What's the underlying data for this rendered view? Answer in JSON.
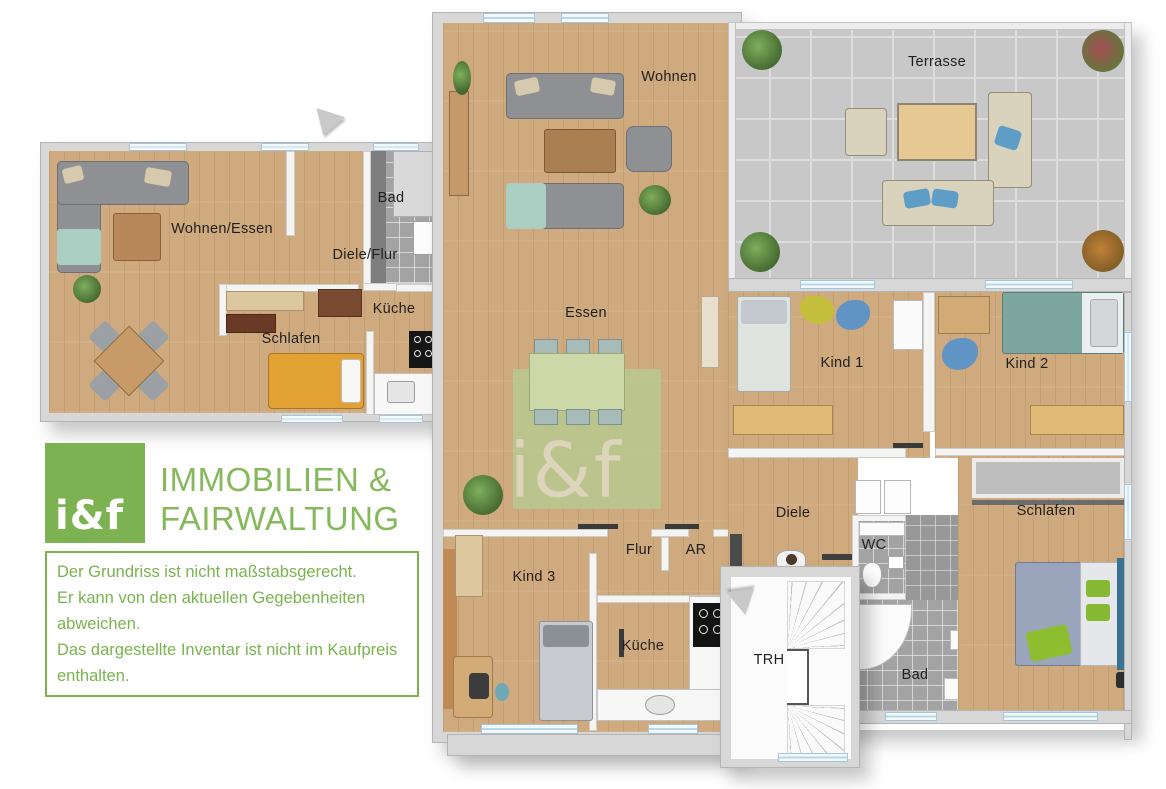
{
  "branding": {
    "logo_text": "i&f",
    "company_name_line1": "IMMOBILIEN &",
    "company_name_line2": "FAIRWALTUNG",
    "brand_green": "#7cb251",
    "disclaimer": {
      "line1": "Der Grundriss ist nicht maßstabsgerecht.",
      "line2": "Er kann von den aktuellen Gegebenheiten abweichen.",
      "line3": "Das dargestellte Inventar ist nicht im Kaufpreis enthalten."
    }
  },
  "watermark_text": "i&f",
  "floorplan": {
    "rooms": {
      "left_wohnen_essen": {
        "label": "Wohnen/Essen"
      },
      "left_diele_flur": {
        "label": "Diele/Flur"
      },
      "left_bad": {
        "label": "Bad"
      },
      "left_kueche": {
        "label": "Küche"
      },
      "left_schlafen": {
        "label": "Schlafen"
      },
      "main_wohnen": {
        "label": "Wohnen"
      },
      "main_essen": {
        "label": "Essen"
      },
      "terrasse": {
        "label": "Terrasse"
      },
      "kind_1": {
        "label": "Kind 1"
      },
      "kind_2": {
        "label": "Kind 2"
      },
      "diele": {
        "label": "Diele"
      },
      "wc": {
        "label": "WC"
      },
      "main_schlafen": {
        "label": "Schlafen"
      },
      "kind_3": {
        "label": "Kind 3"
      },
      "flur": {
        "label": "Flur"
      },
      "ar": {
        "label": "AR"
      },
      "main_kueche": {
        "label": "Küche"
      },
      "trh": {
        "label": "TRH"
      },
      "main_bad": {
        "label": "Bad"
      }
    },
    "palette": {
      "wood_floor": "#cfaa7e",
      "bath_tile": "#a3a3a3",
      "terrace_tile": "#c8c8c8",
      "outer_wall": "#d7d7d7",
      "dining_rug_green": "#b7c98f",
      "window_blue": "#a4c6d8"
    }
  }
}
